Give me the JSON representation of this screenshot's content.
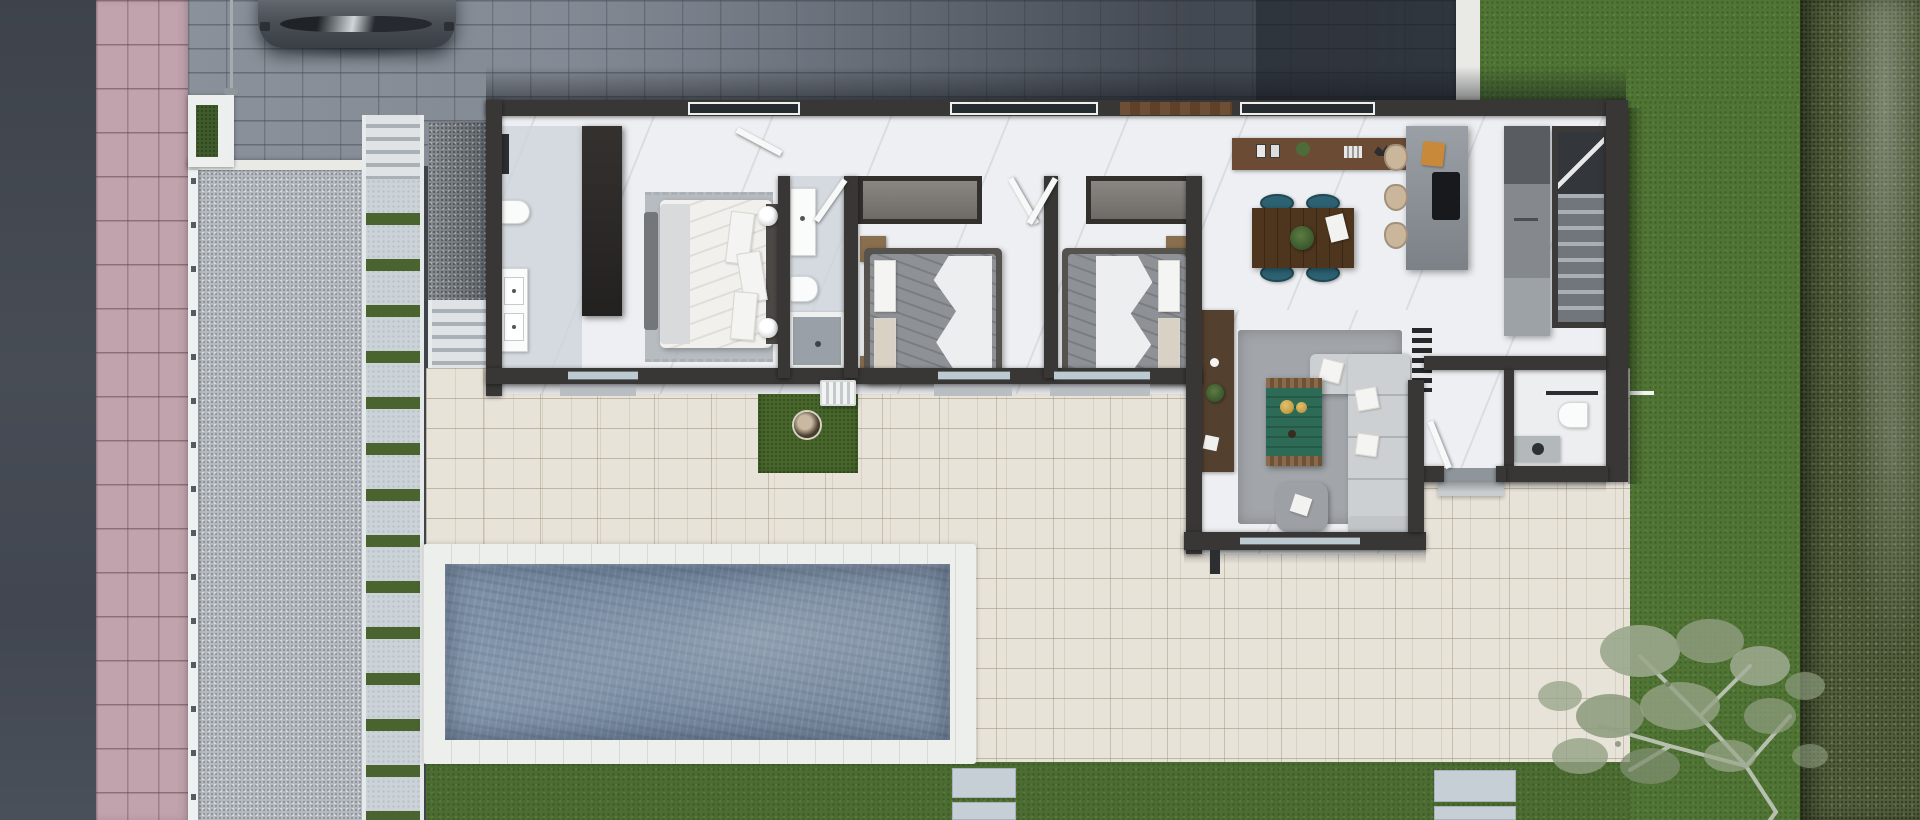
{
  "meta": {
    "image_type": "3d-aerial-floor-plan-render",
    "view": "top-down",
    "canvas": {
      "width": 1920,
      "height": 820
    }
  },
  "palette": {
    "sidewalk": "#c0a3ac",
    "paver": "#868c95",
    "kerb": "#e9eae6",
    "lawn": "#4c6c32",
    "lawn2": "#507434",
    "rough": "#55613d",
    "gravel": "#b5bbc0",
    "joint": "#49642f",
    "patio": "#e8e3d9",
    "pool": "#7489a0",
    "coping": "#edefec",
    "floor": "#edeff2",
    "wall": "#393735",
    "wood": "#6b4b34",
    "table": "#4e351d",
    "teal": "#2d6273",
    "sofa": "#cdd0d2",
    "ctable": "#2e6b57",
    "orange": "#c8893b",
    "bedw": "#f1f0ed",
    "bedg": "#8e9296",
    "fence": "#eef1f2"
  },
  "scene": {
    "street_side": [
      "road",
      "pink-tile-sidewalk",
      "white-fence-with-posts",
      "lamp-post",
      "paver-driveway",
      "parked-car",
      "corner-planter",
      "gravel-front-yard",
      "side-walkway-with-grass-joints",
      "entry-steps",
      "side-gravel-path",
      "garden-steps"
    ],
    "backyard": [
      "cream-tile-patio",
      "swimming-pool",
      "white-pool-coping",
      "artificial-grass-patch-with-planter",
      "bottom-lawn-strip",
      "stepping-stones",
      "right-lawn",
      "hedge-border",
      "garden-tree"
    ],
    "house": {
      "rooms": [
        {
          "name": "master-bathroom",
          "furniture": [
            "shower-column",
            "toilet",
            "double-sink-vanity"
          ]
        },
        {
          "name": "master-bedroom",
          "furniture": [
            "wardrobe",
            "area-rug",
            "bench",
            "double-bed-white",
            "pillows",
            "nightstand-lamps",
            "open-door"
          ]
        },
        {
          "name": "shared-bathroom",
          "furniture": [
            "sink-counter",
            "toilet",
            "bathtub"
          ]
        },
        {
          "name": "bedroom-2",
          "furniture": [
            "closet-recess",
            "double-bed-gray",
            "white-sheet",
            "pillows",
            "wood-nightstands",
            "open-door",
            "sliding-door"
          ]
        },
        {
          "name": "bedroom-3",
          "furniture": [
            "closet-recess",
            "double-bed-gray",
            "white-sheet",
            "pillows",
            "wood-nightstands",
            "double-open-doors",
            "sliding-door"
          ]
        },
        {
          "name": "kitchen-dining",
          "furniture": [
            "wood-sideboard",
            "dining-table",
            "teal-chairs",
            "center-plant",
            "kitchen-island",
            "cooktop",
            "cutting-board",
            "bar-stools",
            "tall-counter-fridge",
            "staircase"
          ]
        },
        {
          "name": "living-room",
          "furniture": [
            "media-console",
            "decor-plant",
            "gray-rug",
            "l-shaped-sofa",
            "green-coffee-table",
            "gold-bowls",
            "ottoman-pouf"
          ]
        },
        {
          "name": "entry-hall",
          "furniture": [
            "slat-doormat",
            "entry-door",
            "outdoor-step"
          ]
        },
        {
          "name": "powder-room",
          "furniture": [
            "towel-bar",
            "toilet",
            "vanity-with-round-sink"
          ]
        }
      ],
      "exterior_features": [
        "north-windows",
        "wood-fascia-band",
        "sliding-glass-doors",
        "hvac-unit",
        "roof-shadow"
      ]
    }
  }
}
